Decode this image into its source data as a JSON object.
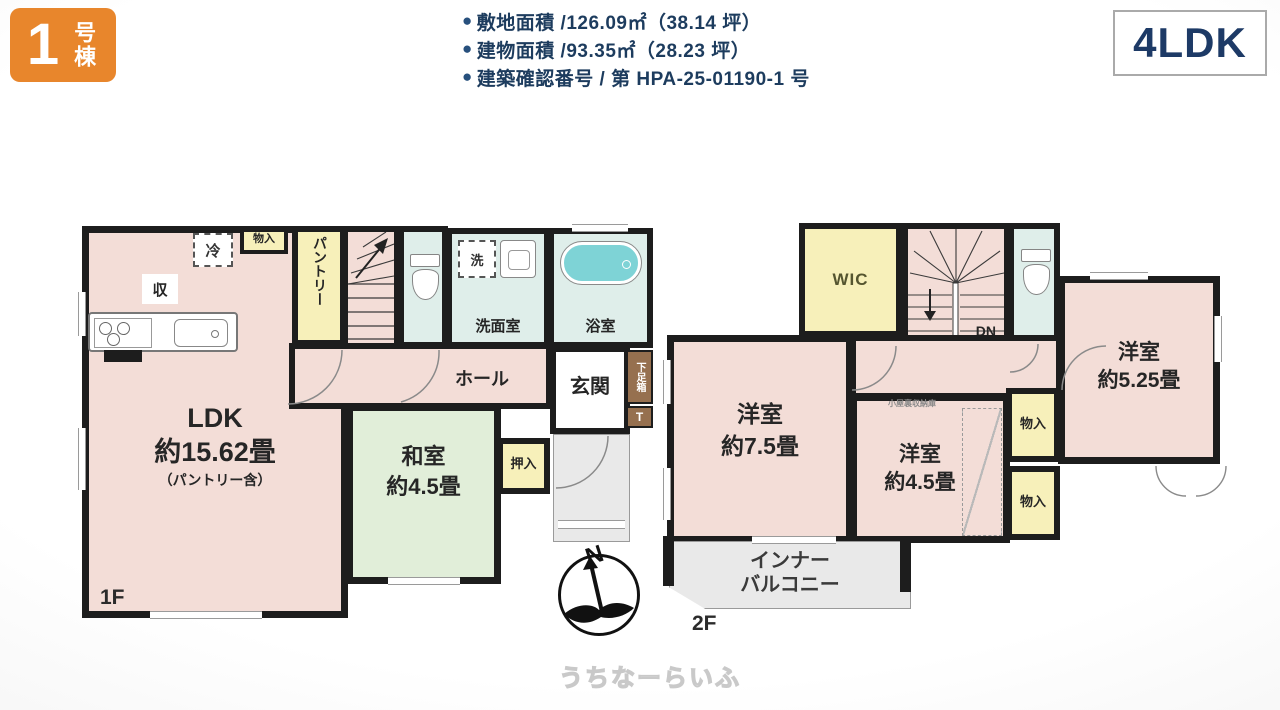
{
  "header": {
    "badge_number": "1",
    "badge_suffix": "号棟",
    "bullet": "●",
    "details": [
      "敷地面積 /126.09㎡（38.14 坪）",
      "建物面積 /93.35㎡（28.23 坪）",
      "建築確認番号 / 第 HPA-25-01190-1 号"
    ],
    "plan_type": "4LDK"
  },
  "floor1": {
    "floor_label": "1F",
    "ldk_name": "LDK",
    "ldk_size": "約15.62畳",
    "ldk_note": "（パントリー含）",
    "washitsu_name": "和室",
    "washitsu_size": "約4.5畳",
    "pantry": "パントリー",
    "stairs_up": "UP",
    "senmenshitsu": "洗面室",
    "bath": "浴室",
    "hall": "ホール",
    "genkan": "玄関",
    "shoebox": "下足箱",
    "shoebox_t": "T",
    "oshiire": "押入",
    "monoire": "物入",
    "fridge": "冷",
    "storage": "収",
    "washer": "洗"
  },
  "floor2": {
    "floor_label": "2F",
    "wic": "WIC",
    "stairs_dn": "DN",
    "room75_name": "洋室",
    "room75_size": "約7.5畳",
    "room45_name": "洋室",
    "room45_size": "約4.5畳",
    "room525_name": "洋室",
    "room525_size": "約5.25畳",
    "attic_note": "小屋裏収納庫",
    "monoire_upper": "物入",
    "monoire_lower": "物入",
    "balcony_line1": "インナー",
    "balcony_line2": "バルコニー"
  },
  "compass": {
    "north": "N"
  },
  "watermark": "うちなーらいふ",
  "colors": {
    "accent_orange": "#e8862c",
    "navy_text": "#1d3c5e",
    "wall": "#1d1d1d",
    "room_pink": "#f3ddd7",
    "room_green": "#e1eed9",
    "room_yellow": "#f7f0ba",
    "room_teal": "#dfeeea",
    "bathtub": "#7ed3d6",
    "shoebox_brown": "#96704f"
  }
}
